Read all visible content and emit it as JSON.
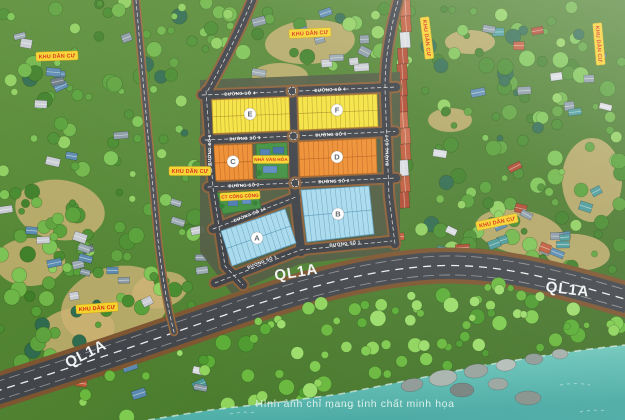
{
  "map": {
    "area_labels": {
      "residential": "KHU DÂN CƯ",
      "culture_house": "NHÀ VĂN HÓA",
      "public_facility": "CT CÔNG CỘNG"
    },
    "highway_label": "QL1A",
    "streets": {
      "s1": "ĐƯỜNG SỐ 1",
      "s1a": "ĐƯỜNG SỐ 1A",
      "s2": "ĐƯỜNG SỐ 2",
      "s3": "ĐƯỜNG SỐ 3",
      "s4": "ĐƯỜNG SỐ 4",
      "s6": "ĐƯỜNG SỐ 6",
      "s7": "ĐƯỜNG SỐ 7"
    },
    "blocks": [
      {
        "id": "E"
      },
      {
        "id": "F"
      },
      {
        "id": "C"
      },
      {
        "id": "D"
      },
      {
        "id": "A"
      },
      {
        "id": "B"
      }
    ],
    "colors": {
      "block_yellow": "#f4e23c",
      "block_orange": "#ee8c2e",
      "block_blue": "#a6d9ec",
      "label_bg": "#f6d32b",
      "label_text": "#d62a12",
      "road_asphalt": "#42464b",
      "road_edge": "#8a5e36",
      "sea": "#63bfb4"
    },
    "disclaimer": "Hình ảnh chỉ mang tính chất minh họa"
  }
}
